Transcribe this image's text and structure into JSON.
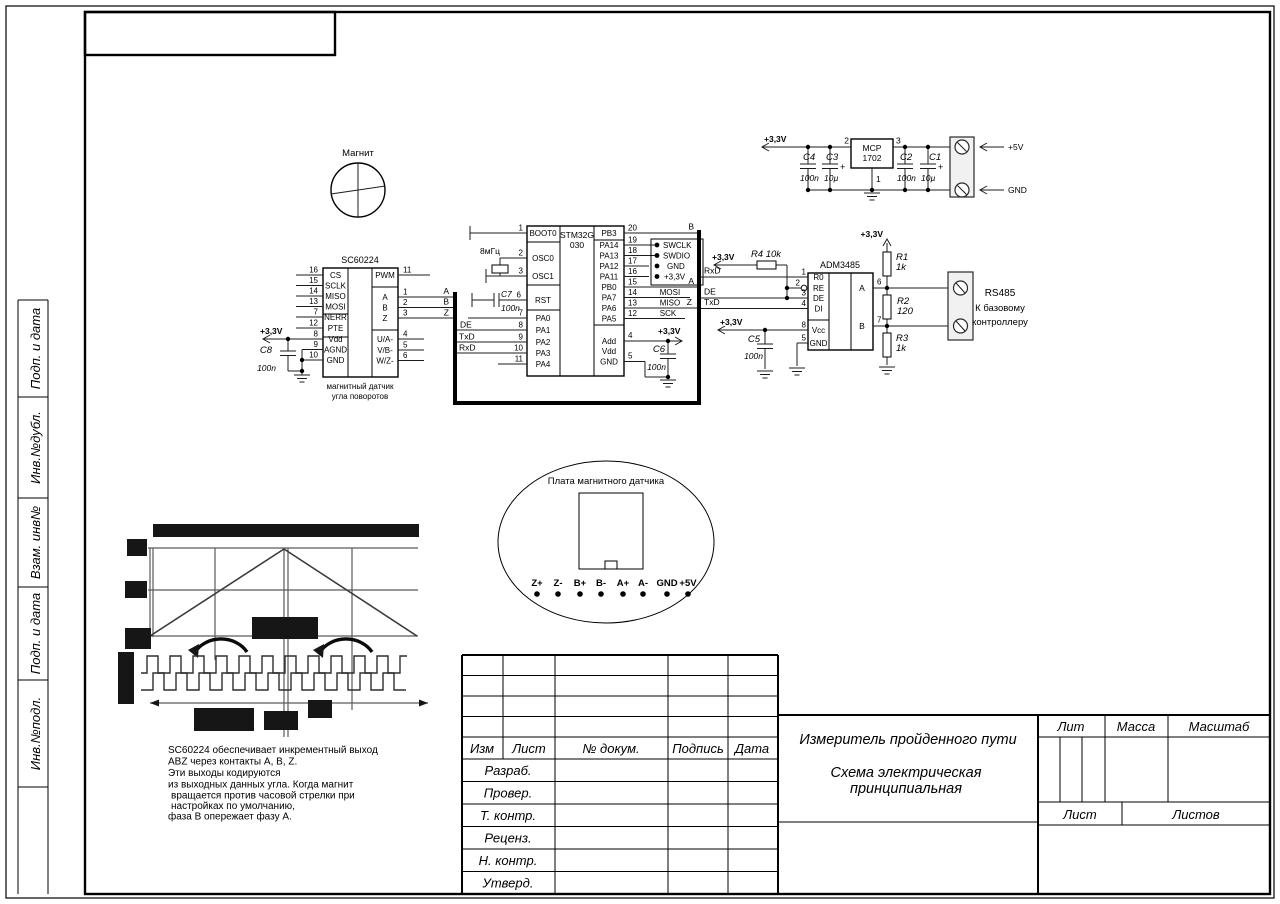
{
  "p33": "+3,3V",
  "p5": "+5V",
  "gnd_label": "GND",
  "frame": {
    "side_labels": [
      "Подп. и дата",
      "Инв.№дубл.",
      "Взам. инв№",
      "Подп. и дата",
      "Инв.№подл."
    ]
  },
  "title_block": {
    "col_izm": "Изм",
    "col_list": "Лист",
    "col_doc": "№ докум.",
    "col_sign": "Подпись",
    "col_date": "Дата",
    "roles": [
      "Разраб.",
      "Провер.",
      "Т. контр.",
      "Реценз.",
      "Н. контр.",
      "Утверд."
    ],
    "title1": "Измеритель пройденного пути",
    "title2": "Схема электрическая",
    "title3": "принципиальная",
    "lit": "Лит",
    "mass": "Масса",
    "scale": "Масштаб",
    "sheet": "Лист",
    "sheets": "Листов"
  },
  "note_lines": [
    "SC60224 обеспечивает инкрементный выход",
    "ABZ через контакты A, B, Z.",
    "Эти выходы кодируются",
    "из выходных данных угла. Когда магнит",
    "вращается против часовой стрелки при",
    "настройках по умолчанию,",
    "фаза B опережает фазу A."
  ],
  "magnet_label": "Магнит",
  "board": {
    "label": "Плата магнитного датчика",
    "pins": [
      "Z+",
      "Z-",
      "B+",
      "B-",
      "A+",
      "A-",
      "GND",
      "+5V"
    ]
  },
  "sc": {
    "title": "SC60224",
    "caption1": "магнитный датчик",
    "caption2": "угла поворотов",
    "lp": [
      [
        "16",
        "CS"
      ],
      [
        "15",
        "SCLK"
      ],
      [
        "14",
        "MISO"
      ],
      [
        "13",
        "MOSI"
      ],
      [
        "7",
        "NERR"
      ],
      [
        "12",
        "PTE"
      ],
      [
        "8",
        "Vdd"
      ],
      [
        "9",
        "AGND"
      ],
      [
        "10",
        "GND"
      ]
    ],
    "rp": [
      [
        "11",
        "PWM"
      ],
      [
        "1",
        "A"
      ],
      [
        "2",
        "B"
      ],
      [
        "3",
        "Z"
      ],
      [
        "4",
        "U/A-"
      ],
      [
        "5",
        "V/B-"
      ],
      [
        "6",
        "W/Z-"
      ]
    ],
    "nets": [
      "A",
      "B",
      "Z"
    ],
    "c8": "C8",
    "c8v": "100n"
  },
  "mcu": {
    "title1": "STM32G",
    "title2": "030",
    "lp": [
      [
        "1",
        "BOOT0"
      ],
      [
        "2",
        "OSC0"
      ],
      [
        "3",
        "OSC1"
      ],
      [
        "6",
        "RST"
      ],
      [
        "7",
        "PA0"
      ],
      [
        "8",
        "PA1"
      ],
      [
        "9",
        "PA2"
      ],
      [
        "10",
        "PA3"
      ],
      [
        "11",
        "PA4"
      ]
    ],
    "rp": [
      [
        "20",
        "PB3"
      ],
      [
        "19",
        "PA14"
      ],
      [
        "18",
        "PA13"
      ],
      [
        "17",
        "PA12"
      ],
      [
        "16",
        "PA11"
      ],
      [
        "15",
        "PB0"
      ],
      [
        "14",
        "PA7"
      ],
      [
        "13",
        "PA6"
      ],
      [
        "12",
        "PA5"
      ]
    ],
    "bp": [
      [
        "4",
        "Add"
      ],
      [
        "",
        "Vdd"
      ],
      [
        "5",
        "GND"
      ]
    ],
    "xtal": "8мГц",
    "c7": "C7",
    "c7v": "100n",
    "c7n": "6",
    "c6": "C6",
    "c6v": "100n",
    "swd": [
      "SWCLK",
      "SWDIO",
      "GND",
      "+3,3V"
    ],
    "spi": [
      "MOSI",
      "MISO",
      "SCK"
    ],
    "nets_l": [
      "A",
      "B",
      "Z",
      "DE",
      "TxD",
      "RxD"
    ],
    "nets_r": [
      "B",
      "A",
      "Z"
    ]
  },
  "rs485": {
    "title": "ADM3485",
    "lp": [
      [
        "1",
        "R0"
      ],
      [
        "2",
        "RE"
      ],
      [
        "3",
        "DE"
      ],
      [
        "4",
        "DI"
      ],
      [
        "8",
        "Vcc"
      ],
      [
        "5",
        "GND"
      ]
    ],
    "rp": [
      [
        "6",
        "A"
      ],
      [
        "7",
        "B"
      ]
    ],
    "sig": [
      "RxD",
      "DE",
      "TxD"
    ],
    "r4": "R4 10k",
    "r1": "R1",
    "r1v": "1k",
    "r2": "R2",
    "r2v": "120",
    "r3": "R3",
    "r3v": "1k",
    "c5": "C5",
    "c5v": "100n",
    "conn1": "RS485",
    "conn2": "К базовому",
    "conn3": "контроллеру"
  },
  "reg": {
    "title1": "MCP",
    "title2": "1702",
    "pin2": "2",
    "pin3": "3",
    "pin1": "1",
    "c4": "C4",
    "c4v": "100n",
    "c3": "C3",
    "c3v": "10µ",
    "c2": "C2",
    "c2v": "100n",
    "c1": "C1",
    "c1v": "10µ",
    "plus": "+"
  }
}
